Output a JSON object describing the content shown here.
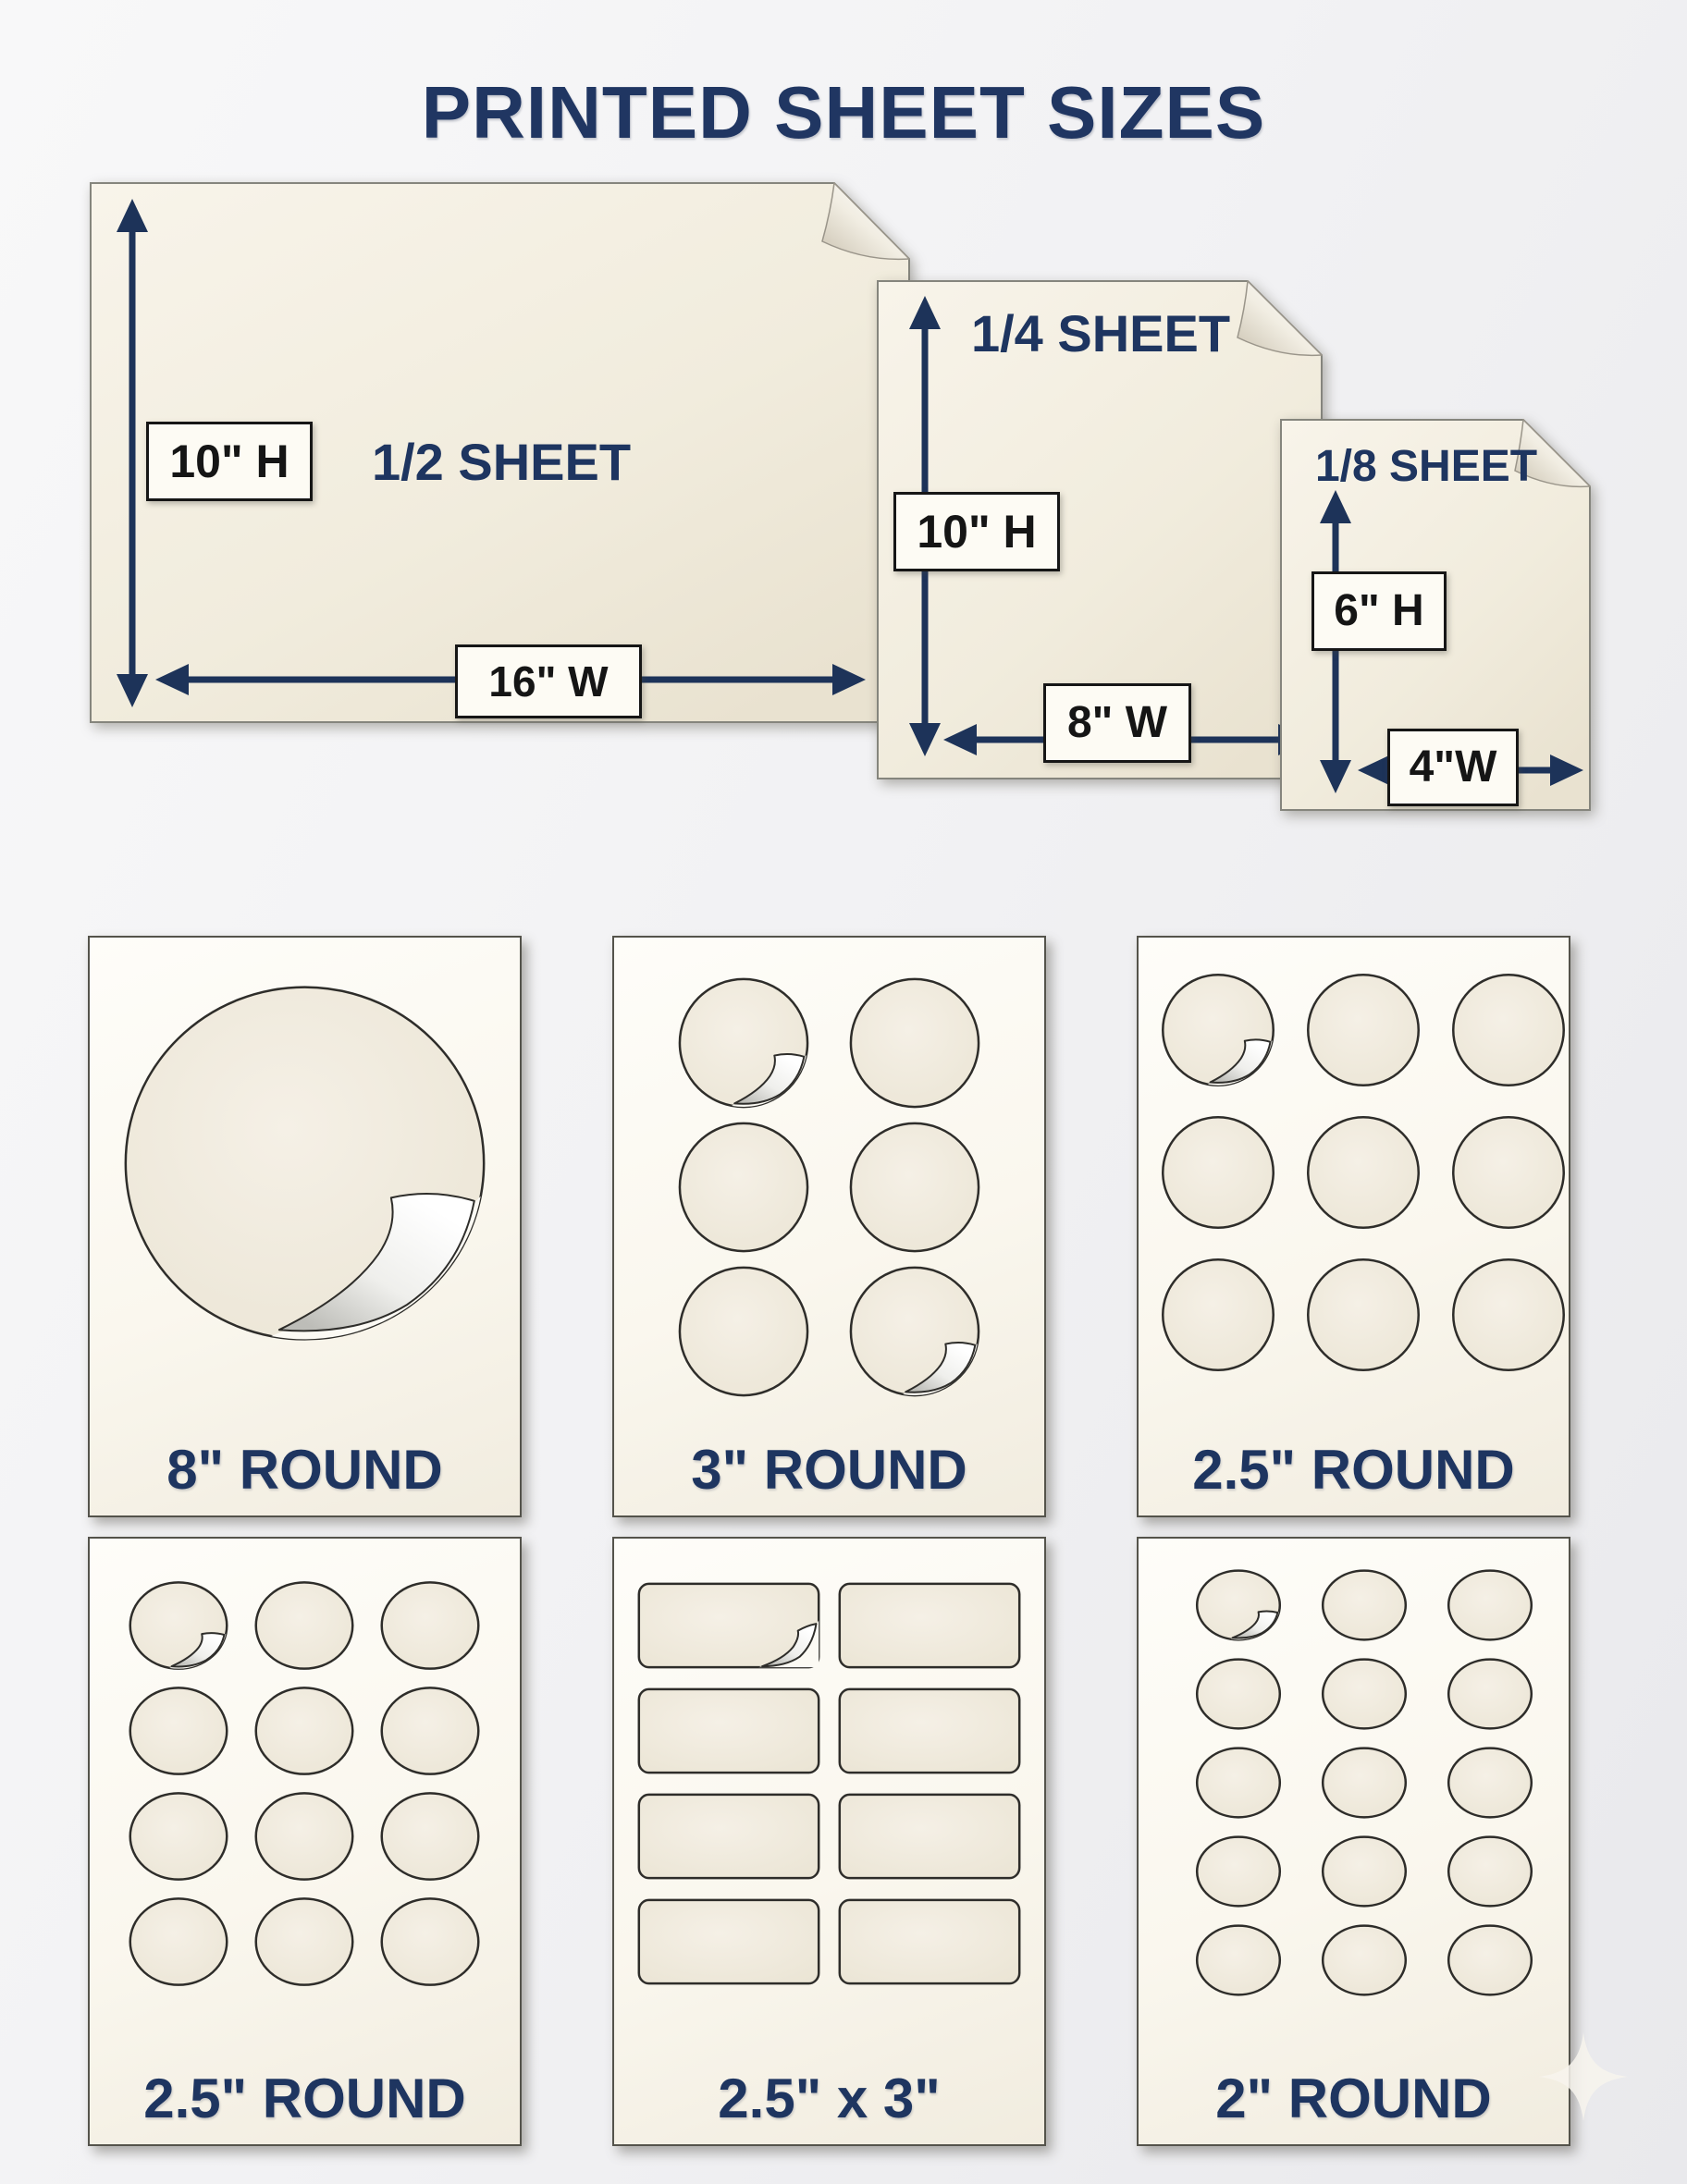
{
  "title": "PRINTED SHEET SIZES",
  "colors": {
    "navy_accent": "#1e3560",
    "paper_cream": "#f3eee2",
    "card_white": "#fcfaf2",
    "outline_dark": "#2e2d2a",
    "background": "#f1f1f3"
  },
  "sheets": [
    {
      "name": "half-sheet",
      "label": "1/2 SHEET",
      "height_label": "10\" H",
      "width_label": "16\" W"
    },
    {
      "name": "quarter-sheet",
      "label": "1/4 SHEET",
      "height_label": "10\" H",
      "width_label": "8\" W"
    },
    {
      "name": "eighth-sheet",
      "label": "1/8 SHEET",
      "height_label": "6\" H",
      "width_label": "4\"W"
    }
  ],
  "cards": [
    {
      "name": "round-8",
      "label": "8\" ROUND",
      "shape": "circle",
      "rows": 1,
      "cols": 1,
      "count": 1
    },
    {
      "name": "round-3",
      "label": "3\" ROUND",
      "shape": "circle",
      "rows": 3,
      "cols": 2,
      "count": 6
    },
    {
      "name": "round-2.5-9up",
      "label": "2.5\" ROUND",
      "shape": "circle",
      "rows": 3,
      "cols": 3,
      "count": 9
    },
    {
      "name": "round-2.5-12up",
      "label": "2.5\" ROUND",
      "shape": "circle",
      "rows": 4,
      "cols": 3,
      "count": 12
    },
    {
      "name": "rect-2.5x3",
      "label": "2.5\" x 3\"",
      "shape": "rect",
      "rows": 4,
      "cols": 2,
      "count": 8
    },
    {
      "name": "round-2",
      "label": "2\" ROUND",
      "shape": "circle",
      "rows": 5,
      "cols": 3,
      "count": 15
    }
  ]
}
